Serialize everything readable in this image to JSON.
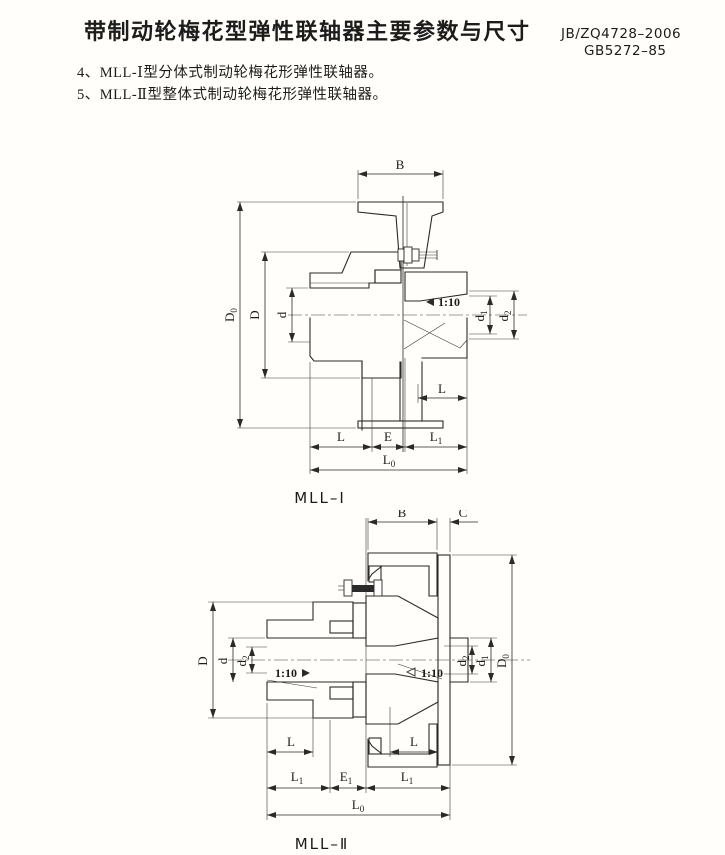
{
  "header": {
    "title": "带制动轮梅花型弹性联轴器主要参数与尺寸",
    "standard1": "JB/ZQ4728–2006",
    "standard2": "GB5272–85"
  },
  "notes": [
    {
      "text": "4、MLL-Ⅰ型分体式制动轮梅花形弹性联轴器。"
    },
    {
      "text": "5、MLL-Ⅱ型整体式制动轮梅花形弹性联轴器。"
    }
  ],
  "dims": {
    "B": "B",
    "C": "C",
    "D": "D",
    "d": "d",
    "L": "L",
    "E": "E",
    "D0": {
      "b": "D",
      "s": "0"
    },
    "d1": {
      "b": "d",
      "s": "1"
    },
    "d2": {
      "b": "d",
      "s": "2"
    },
    "L1": {
      "b": "L",
      "s": "1"
    },
    "L0": {
      "b": "L",
      "s": "0"
    },
    "E1": {
      "b": "E",
      "s": "1"
    },
    "taper": "1:10"
  },
  "figures": {
    "fig1": {
      "caption": "MLL–Ⅰ"
    },
    "fig2": {
      "caption": "MLL–Ⅱ"
    }
  }
}
